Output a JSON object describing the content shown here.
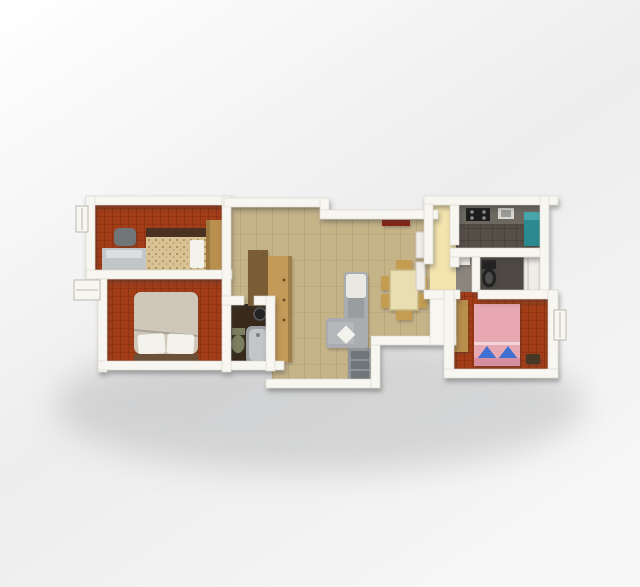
{
  "scene": {
    "type": "3d-rendered-floor-plan",
    "view": "top-down",
    "background_light": "#fdfdfd",
    "background_shade": "#e2e3e4"
  },
  "palette": {
    "wall": "#f8f6f1",
    "wall_stroke": "#d8d4cc",
    "window_frame": "#c6c2ba",
    "carpet_red": "#a23d18",
    "carpet_red_line": "#7e2c0f",
    "floor_tan": "#c6b489",
    "floor_tan_line": "#ab9a70",
    "floor_yellow": "#f4e4ae",
    "kitchen_floor": "#564f47",
    "kitchen_floor_line": "#423c34",
    "bath_small_floor": "#38291a",
    "bath_left_floor": "#8b867c",
    "bath_right_floor": "#4e4942",
    "counter_gray": "#6c6861",
    "stove_black": "#1f1f1f",
    "sink_gray": "#d8d6d0",
    "teal_appliance": "#2a8a8f",
    "wood_light": "#c49a58",
    "wood_mid": "#b98f4d",
    "wood_dark": "#7a5b35",
    "bed_floral": "#d9c394",
    "bed_floral_dot": "#8a6a3e",
    "bed_headboard": "#4a3220",
    "bed_beige": "#cfc8ba",
    "bed_frame_dark": "#6b5138",
    "bed_pink": "#e7a8b2",
    "bed_pink_dark": "#d68fa0",
    "pillow_white": "#f4f2ec",
    "pillow_blue": "#3f6fd1",
    "sofa_gray": "#a9adb0",
    "sofa_cushion": "#e9e8e2",
    "table_cream": "#e9ddb2",
    "chair_tan": "#c49d52",
    "tv_red": "#8e2415",
    "storage_gray": "#90959a",
    "storage_dark": "#6f747a",
    "desk_gray": "#c3c6c9",
    "chair_gray": "#6f7478",
    "toilet_olive": "#7b7f5e",
    "toilet_black": "#222222",
    "tub_gray": "#9aa0a3",
    "tub_inner": "#c2c6c9",
    "fixture_white": "#efede8",
    "nightstand_dark": "#473828"
  },
  "plan": {
    "rooms": [
      {
        "name": "bedroom-top-left",
        "floor": "red carpet",
        "furniture": [
          "double bed with floral cover",
          "dressing table",
          "chair",
          "wardrobe"
        ]
      },
      {
        "name": "bedroom-bottom-left",
        "floor": "red carpet",
        "furniture": [
          "double bed with beige duvet",
          "two white pillows"
        ]
      },
      {
        "name": "bathroom-small",
        "floor": "dark mosaic tile",
        "furniture": [
          "toilet",
          "bathtub",
          "washbasin"
        ]
      },
      {
        "name": "living-dining-room",
        "floor": "beige tile",
        "furniture": [
          "corner sofa",
          "dining table",
          "six chairs",
          "tall wardrobe",
          "sideboard",
          "wall tv panel",
          "shelf units",
          "storage cabinet"
        ]
      },
      {
        "name": "hallway",
        "floor": "cream tile"
      },
      {
        "name": "kitchen",
        "floor": "dark tile",
        "furniture": [
          "counter with cooktop",
          "sink",
          "teal refrigerator"
        ]
      },
      {
        "name": "bathroom-main",
        "floor": "tile",
        "furniture": [
          "washbasin",
          "toilet",
          "shower"
        ]
      },
      {
        "name": "bedroom-bottom-right",
        "floor": "red carpet",
        "furniture": [
          "double bed with pink cover",
          "two blue pillows",
          "wardrobe",
          "nightstand"
        ]
      }
    ]
  }
}
